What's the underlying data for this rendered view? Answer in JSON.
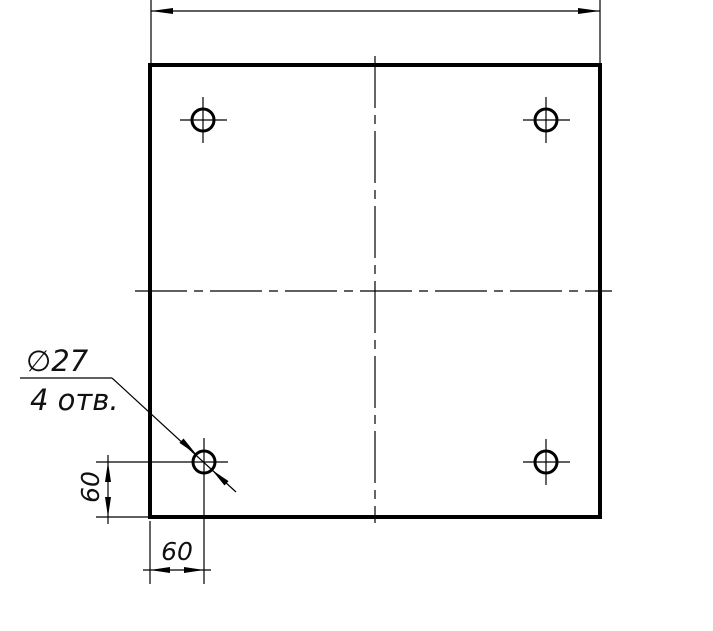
{
  "drawing": {
    "kind": "engineering-drawing",
    "subject": "square plate, front view, four through holes",
    "labels": {
      "hole_diameter": "∅27",
      "hole_count": "4 отв.",
      "dim_left_value": "60",
      "dim_bottom_value": "60"
    },
    "dimension_data": {
      "hole_diameter_mm": 27,
      "number_of_holes": 4,
      "hole_offset_from_bottom_mm": 60,
      "hole_offset_from_left_mm": 60,
      "top_overall_dimension_text_visible": false
    },
    "colors": {
      "ink": "#000000",
      "paper": "#ffffff"
    }
  }
}
